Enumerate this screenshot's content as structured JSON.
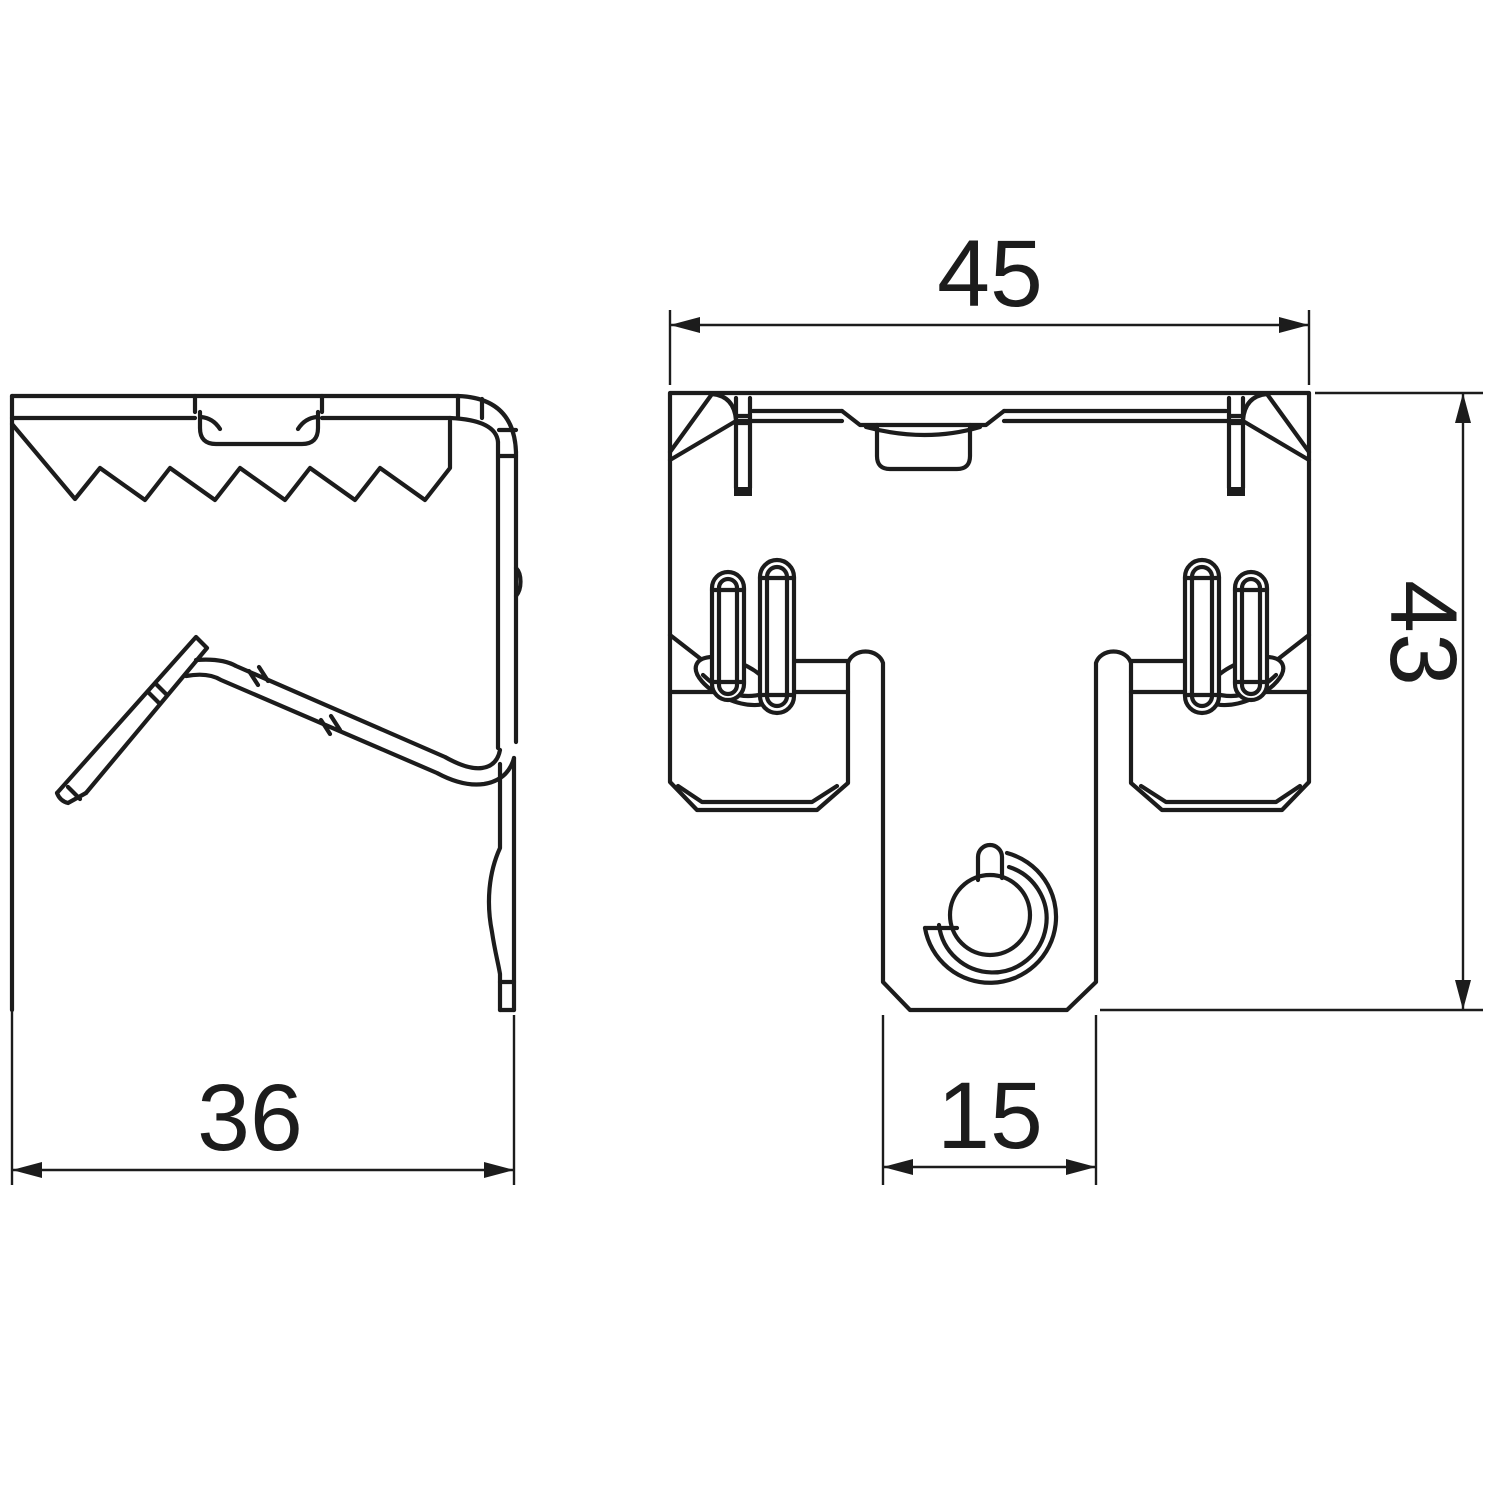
{
  "drawing": {
    "type": "technical-drawing",
    "views": [
      {
        "id": "side",
        "name": "side view"
      },
      {
        "id": "front",
        "name": "front view"
      }
    ],
    "dimensions": {
      "front_width": {
        "value": "45",
        "orientation": "horizontal",
        "view": "front"
      },
      "front_height": {
        "value": "43",
        "orientation": "vertical",
        "view": "front"
      },
      "side_depth": {
        "value": "36",
        "orientation": "horizontal",
        "view": "side"
      },
      "channel_width": {
        "value": "15",
        "orientation": "horizontal",
        "view": "front"
      }
    },
    "colors": {
      "line": "#1c1c1c",
      "background": "#ffffff"
    }
  }
}
